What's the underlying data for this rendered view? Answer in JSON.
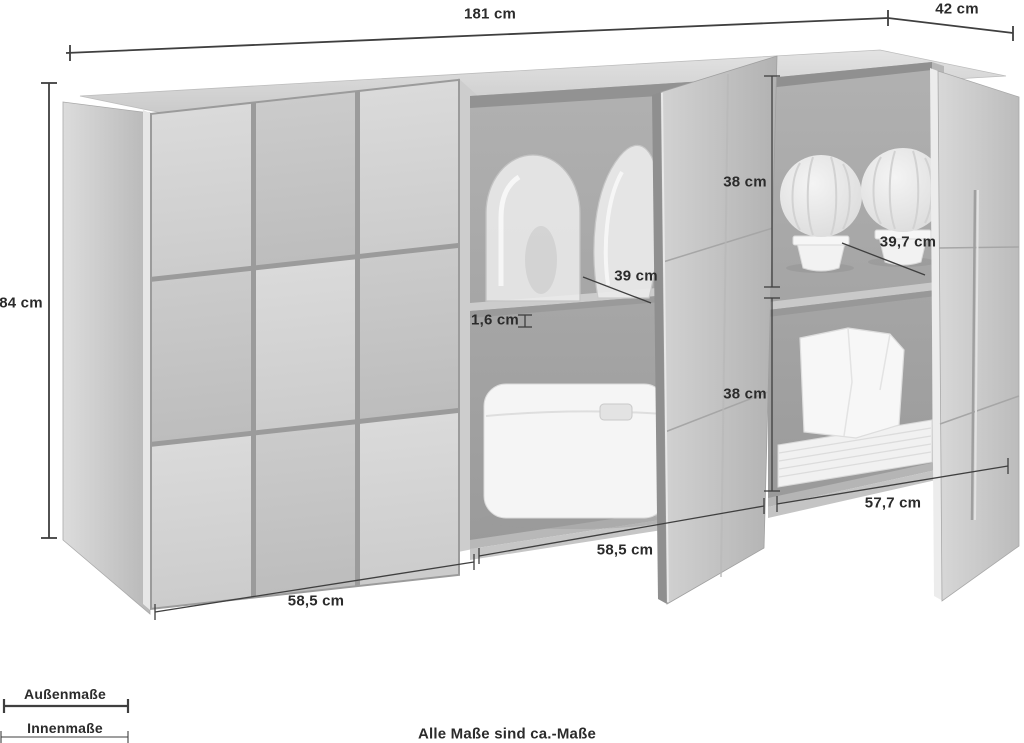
{
  "measurements": {
    "outer_width": "181 cm",
    "outer_depth": "42 cm",
    "outer_height": "84 cm",
    "upper_compartment_height": "38 cm",
    "lower_compartment_height": "38 cm",
    "right_shelf_depth": "39,7 cm",
    "middle_shelf_depth": "39 cm",
    "shelf_thickness": "1,6 cm",
    "middle_inner_width": "58,5 cm",
    "left_inner_width": "58,5 cm",
    "right_inner_width": "57,7 cm"
  },
  "legend": {
    "outer_label": "Außenmaße",
    "inner_label": "Innenmaße"
  },
  "footnote": "Alle Maße sind ca.-Maße",
  "colors": {
    "background": "#ffffff",
    "dimension_line": "#3f3f3f",
    "label_text": "#2b2b2b",
    "cabinet_light": "#d9d9d9",
    "cabinet_mid": "#c4c4c4",
    "interior_dark": "#a0a0a0"
  }
}
